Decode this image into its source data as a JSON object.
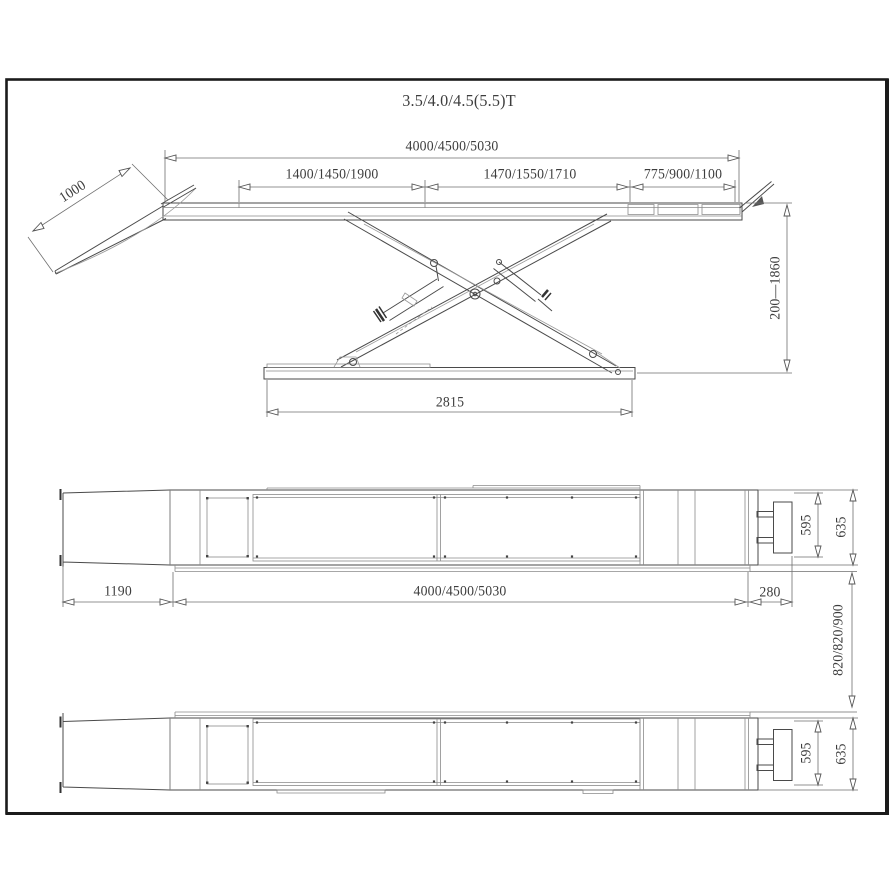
{
  "drawing": {
    "title": "3.5/4.0/4.5(5.5)T",
    "side_view": {
      "total_length": "4000/4500/5030",
      "segment_left": "1400/1450/1900",
      "segment_middle": "1470/1550/1710",
      "segment_right": "775/900/1100",
      "drive_on_ramp_length": "1000",
      "lift_height_range": "200—1860",
      "base_frame_length": "2815"
    },
    "plan_view_top": {
      "ramp_length": "1190",
      "platform_length": "4000/4500/5030",
      "rear_extension": "280",
      "plate_width": "595",
      "platform_width": "635"
    },
    "between_views": {
      "track_gap_range": "820/820/900"
    },
    "plan_view_bottom": {
      "plate_width": "595",
      "platform_width": "635"
    },
    "colors": {
      "frame_border": "#1b1b1b",
      "line_work": "#4a4a4a",
      "dimension_text": "#3d3d3d",
      "background": "#ffffff"
    }
  }
}
